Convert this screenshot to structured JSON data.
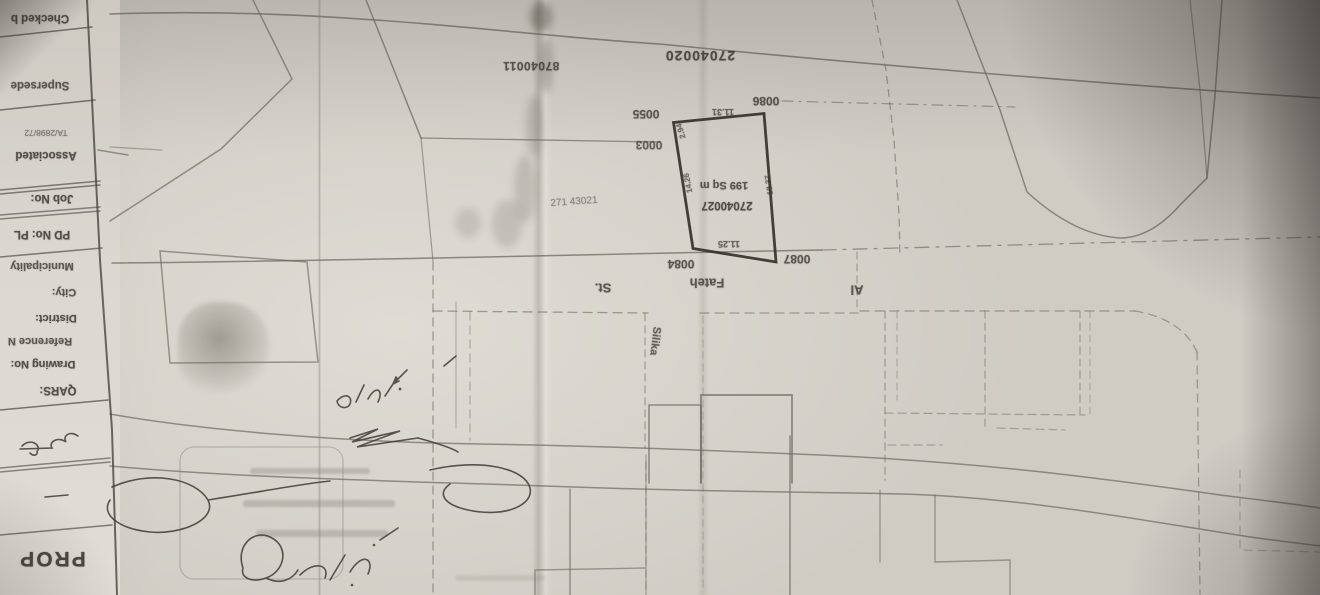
{
  "document": {
    "kind": "photographed cadastral site plan, sheet appears upside-down in photo",
    "highlighted_plot": {
      "parcel_number": "27040027",
      "area": "199 Sq m",
      "edge_dimensions": {
        "top": "11.31",
        "bottom": "11.25",
        "left": "14.26",
        "right": "18.37",
        "corner": "2.94"
      },
      "street": "Al Fateh St.",
      "cross_street": "Silika"
    }
  },
  "colors": {
    "paper": "#d6d3cb",
    "pencil_line": "#6f6a61",
    "dark_line": "#4a463f",
    "bold_parcel": "#36322a",
    "ink_text": "#3a362f",
    "shadow": "#25231f"
  },
  "title_block": {
    "rows": [
      {
        "name": "title-row-checked-by",
        "text": "Checked b",
        "x": 40,
        "y": 18,
        "s": 11.5,
        "r": 180,
        "w": 700,
        "o": 0.85
      },
      {
        "name": "title-row-supersede",
        "text": "Supersede",
        "x": 40,
        "y": 85,
        "s": 11.5,
        "r": 180,
        "w": 700,
        "o": 0.8
      },
      {
        "name": "title-row-assoc-ref",
        "text": "TA/2898/72",
        "x": 46,
        "y": 133,
        "s": 8.5,
        "r": 180,
        "w": 400,
        "o": 0.6
      },
      {
        "name": "title-row-associated",
        "text": "Associated",
        "x": 46,
        "y": 155,
        "s": 11.5,
        "r": 180,
        "w": 700,
        "o": 0.85
      },
      {
        "name": "title-row-job-no",
        "text": "Job No:",
        "x": 52,
        "y": 198,
        "s": 11.5,
        "r": 180,
        "w": 700,
        "o": 0.85
      },
      {
        "name": "title-row-pd-no",
        "text": "PD No:  PL",
        "x": 42,
        "y": 234,
        "s": 11.5,
        "r": 180,
        "w": 700,
        "o": 0.85
      },
      {
        "name": "title-row-municipality",
        "text": "Municipality",
        "x": 42,
        "y": 266,
        "s": 11,
        "r": 180,
        "w": 700,
        "o": 0.8
      },
      {
        "name": "title-row-city",
        "text": "City:",
        "x": 64,
        "y": 292,
        "s": 11,
        "r": 180,
        "w": 700,
        "o": 0.8
      },
      {
        "name": "title-row-district",
        "text": "District:",
        "x": 56,
        "y": 318,
        "s": 11,
        "r": 180,
        "w": 700,
        "o": 0.85
      },
      {
        "name": "title-row-reference-no",
        "text": "Reference N",
        "x": 40,
        "y": 341,
        "s": 11,
        "r": 180,
        "w": 700,
        "o": 0.8
      },
      {
        "name": "title-row-drawing-no",
        "text": "Drawing No:",
        "x": 43,
        "y": 364,
        "s": 11,
        "r": 180,
        "w": 700,
        "o": 0.85
      },
      {
        "name": "title-row-qars",
        "text": "QARS:",
        "x": 58,
        "y": 390,
        "s": 11.5,
        "r": 180,
        "w": 700,
        "o": 0.85
      },
      {
        "name": "title-row-prop",
        "text": "PROP",
        "x": 52,
        "y": 558,
        "s": 21,
        "r": 180,
        "w": 700,
        "o": 0.9,
        "ls": 2
      }
    ],
    "handwritten_note": "handwritten-arabic-title-note"
  },
  "map": {
    "labels": [
      {
        "name": "parcel-number-27040020",
        "text": "27040020",
        "x": 700,
        "y": 56,
        "s": 14,
        "r": 180,
        "w": 600,
        "o": 0.85,
        "ls": 1
      },
      {
        "name": "parcel-number-87040011",
        "text": "87040011",
        "x": 531,
        "y": 66,
        "s": 12,
        "r": 180,
        "w": 600,
        "o": 0.8,
        "ls": 0.5
      },
      {
        "name": "plot-ref-0086",
        "text": "0086",
        "x": 766,
        "y": 101,
        "s": 12,
        "r": 180,
        "w": 600,
        "o": 0.8
      },
      {
        "name": "plot-ref-0055",
        "text": "0055",
        "x": 646,
        "y": 114,
        "s": 12,
        "r": 180,
        "w": 600,
        "o": 0.78
      },
      {
        "name": "plot-ref-0003",
        "text": "0003",
        "x": 649,
        "y": 145,
        "s": 12,
        "r": 180,
        "w": 600,
        "o": 0.72
      },
      {
        "name": "dim-top-11-31",
        "text": "11.31",
        "x": 723,
        "y": 112,
        "s": 9,
        "r": 180,
        "w": 600,
        "o": 0.7
      },
      {
        "name": "dim-corner-2-94",
        "text": "2.94",
        "x": 681,
        "y": 131,
        "s": 8,
        "r": 253,
        "w": 600,
        "o": 0.65
      },
      {
        "name": "plot-area-199-sqm",
        "text": "199 Sq m",
        "x": 724,
        "y": 185,
        "s": 11,
        "r": 180,
        "w": 600,
        "o": 0.8
      },
      {
        "name": "parcel-number-27040027",
        "text": "27040027",
        "x": 727,
        "y": 205,
        "s": 11.5,
        "r": 180,
        "w": 600,
        "o": 0.85
      },
      {
        "name": "dim-left-14-26",
        "text": "14.26",
        "x": 688,
        "y": 183,
        "s": 8,
        "r": 259,
        "w": 600,
        "o": 0.65
      },
      {
        "name": "dim-right-18-37",
        "text": "18.37",
        "x": 769,
        "y": 185,
        "s": 8,
        "r": 261,
        "w": 600,
        "o": 0.65
      },
      {
        "name": "dim-bottom-11-25",
        "text": "11.25",
        "x": 729,
        "y": 244,
        "s": 9,
        "r": 180,
        "w": 600,
        "o": 0.72
      },
      {
        "name": "plot-ref-0087",
        "text": "0087",
        "x": 797,
        "y": 259,
        "s": 12,
        "r": 180,
        "w": 600,
        "o": 0.8
      },
      {
        "name": "plot-ref-0084",
        "text": "0084",
        "x": 681,
        "y": 264,
        "s": 12,
        "r": 180,
        "w": 600,
        "o": 0.8
      },
      {
        "name": "street-name-fateh",
        "text": "Fateh",
        "x": 707,
        "y": 283,
        "s": 13,
        "r": 180,
        "w": 600,
        "o": 0.8
      },
      {
        "name": "street-suffix-st",
        "text": "St.",
        "x": 603,
        "y": 288,
        "s": 13,
        "r": 180,
        "w": 600,
        "o": 0.8
      },
      {
        "name": "street-prefix-al",
        "text": "Al",
        "x": 857,
        "y": 290,
        "s": 13,
        "r": 180,
        "w": 600,
        "o": 0.8
      },
      {
        "name": "street-name-silika",
        "text": "Silika",
        "x": 655,
        "y": 341,
        "s": 11,
        "r": 97,
        "w": 600,
        "o": 0.75
      },
      {
        "name": "faint-ref-271-43021",
        "text": "271 43021",
        "x": 574,
        "y": 202,
        "s": 10,
        "r": -4,
        "w": 400,
        "o": 0.5
      }
    ],
    "handwritten_annotations": [
      "handwritten-arabic-plot-note",
      "handwritten-zigzag-mark",
      "handwritten-loop-swoosh",
      "handwritten-arabic-signature"
    ]
  }
}
